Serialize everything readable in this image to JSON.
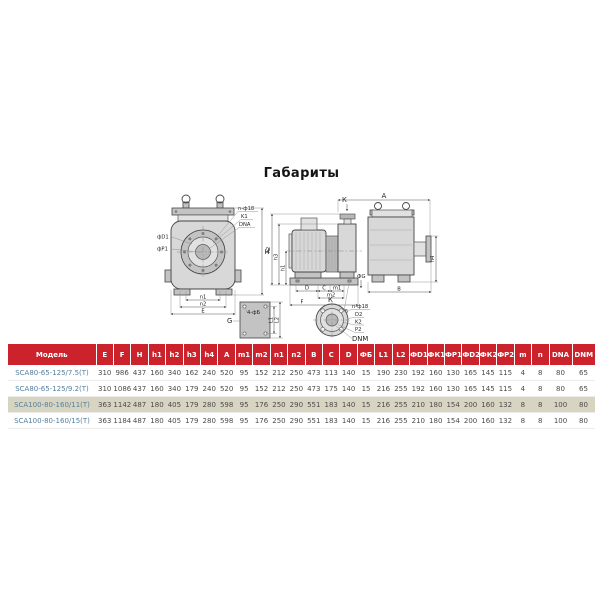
{
  "page": {
    "title": "Габариты"
  },
  "colors": {
    "header_red": "#cb222c",
    "model_blue": "#53809f",
    "highlight_beige": "#d8d4c2"
  },
  "drawing": {
    "front": {
      "fd1": "фD1",
      "fp1": "фР1",
      "bolts": "n-ф18",
      "k1": "K1",
      "dna": "DNA",
      "h": "H",
      "n1": "n1",
      "n2": "n2",
      "e": "Е"
    },
    "side": {
      "k": "К",
      "h1": "h1",
      "h2": "h2",
      "h3": "h3",
      "d": "D",
      "c": "C",
      "m1": "m1",
      "m2": "m2",
      "f": "F",
      "g": "ФG",
      "note": "4-ф15"
    },
    "right": {
      "a": "A",
      "h4": "h4",
      "b": "B"
    },
    "plate": {
      "note": "4-фБ",
      "g": "G",
      "l1": "L1",
      "l2": "L2"
    },
    "flange": {
      "k": "К",
      "bolts": "n-ф18",
      "d2": "D2",
      "k2": "K2",
      "p2": "P2",
      "dnm": "DNM"
    }
  },
  "table": {
    "headers": [
      "Модель",
      "Е",
      "F",
      "H",
      "h1",
      "h2",
      "h3",
      "h4",
      "A",
      "m1",
      "m2",
      "n1",
      "n2",
      "B",
      "C",
      "D",
      "ФБ",
      "L1",
      "L2",
      "ФD1",
      "ФК1",
      "ФР1",
      "ФD2",
      "ФК2",
      "ФР2",
      "m",
      "n",
      "DNA",
      "DNM"
    ],
    "highlighted_row_index": 2,
    "rows": [
      {
        "model": "SCA80-65-125/7.5(T)",
        "values": [
          310,
          986,
          437,
          160,
          340,
          162,
          240,
          520,
          95,
          152,
          212,
          250,
          473,
          113,
          140,
          15,
          190,
          230,
          192,
          160,
          130,
          165,
          145,
          115,
          4,
          8,
          80,
          65
        ]
      },
      {
        "model": "SCA80-65-125/9.2(T)",
        "values": [
          310,
          1086,
          437,
          160,
          340,
          179,
          240,
          520,
          95,
          152,
          212,
          250,
          473,
          175,
          140,
          15,
          216,
          255,
          192,
          160,
          130,
          165,
          145,
          115,
          4,
          8,
          80,
          65
        ]
      },
      {
        "model": "SCA100-80-160/11(T)",
        "values": [
          363,
          1142,
          487,
          180,
          405,
          179,
          280,
          598,
          95,
          176,
          250,
          290,
          551,
          183,
          140,
          15,
          216,
          255,
          210,
          180,
          154,
          200,
          160,
          132,
          8,
          8,
          100,
          80
        ]
      },
      {
        "model": "SCA100-80-160/15(T)",
        "values": [
          363,
          1184,
          487,
          180,
          405,
          179,
          280,
          598,
          95,
          176,
          250,
          290,
          551,
          183,
          140,
          15,
          216,
          255,
          210,
          180,
          154,
          200,
          160,
          132,
          8,
          8,
          100,
          80
        ]
      }
    ]
  }
}
